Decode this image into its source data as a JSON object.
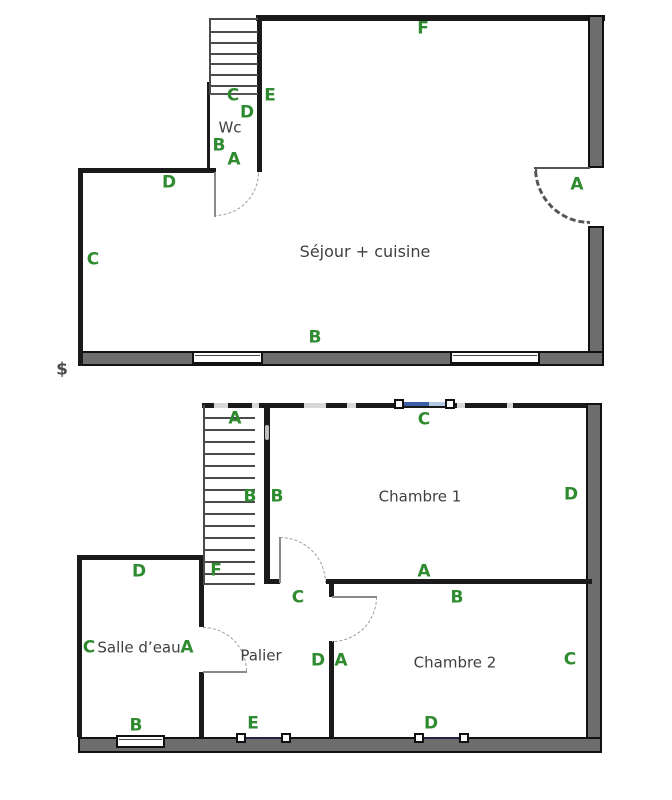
{
  "palette": {
    "wall": "#1a1a1a",
    "ext_fill": "#6d6d6d",
    "door_arc": "#9a9a9a",
    "door_arc_bold": "#565656",
    "marker_green": "#2f8b2f",
    "room_text": "#3f3f3f",
    "velux_dark": "#3d5fa8",
    "velux_light": "#b3c9e6",
    "velux_line": "#23233f"
  },
  "floor1": {
    "name": "ground-floor-plan",
    "walls": [
      [
        "top-wall",
        256,
        15,
        349,
        6,
        "solid"
      ],
      [
        "right-wall-upper",
        588,
        15,
        16,
        153,
        "ext"
      ],
      [
        "right-wall-lower",
        588,
        226,
        16,
        140,
        "ext"
      ],
      [
        "bottom-wall",
        78,
        351,
        526,
        15,
        "ext"
      ],
      [
        "left-wall",
        78,
        168,
        5,
        198,
        "solid"
      ],
      [
        "top-left-wall",
        78,
        168,
        138,
        5,
        "solid"
      ],
      [
        "wc-right-wall",
        257,
        15,
        5,
        157,
        "solid"
      ],
      [
        "wc-left-wall",
        207,
        82,
        3,
        90,
        "solid"
      ],
      [
        "wc-top-line",
        209,
        93,
        49,
        2,
        "thin"
      ]
    ],
    "windows": [
      [
        "window-1",
        192,
        351,
        71,
        13
      ],
      [
        "window-2",
        450,
        351,
        90,
        13
      ]
    ],
    "stairs": [
      {
        "n": "stairs-up",
        "x": 209,
        "y": 18,
        "w": 49,
        "h": 76,
        "treads": 6,
        "edges": [
          "top",
          "left"
        ]
      }
    ],
    "doors": [
      {
        "n": "wc-door",
        "x": 215,
        "y": 172,
        "r": 44,
        "corner": "br",
        "leaf": [
          214,
          172,
          2,
          45
        ]
      },
      {
        "n": "entry-door",
        "x": 534,
        "y": 168,
        "r": 56,
        "corner": "bl",
        "bold": true,
        "leaf": [
          534,
          167,
          56,
          2
        ]
      }
    ],
    "veluxes": [],
    "gaps": [],
    "marks": [],
    "markers": [
      [
        "F",
        423,
        29
      ],
      [
        "C",
        233,
        96
      ],
      [
        "E",
        270,
        96
      ],
      [
        "D",
        247,
        113
      ],
      [
        "B",
        219,
        146
      ],
      [
        "A",
        234,
        160
      ],
      [
        "D",
        169,
        183
      ],
      [
        "A",
        577,
        185
      ],
      [
        "C",
        93,
        260
      ],
      [
        "B",
        315,
        338
      ]
    ],
    "texts": [
      {
        "n": "room-label-wc",
        "t": "Wc",
        "x": 230,
        "y": 128,
        "s": 15
      },
      {
        "n": "room-label-sejour-cuisine",
        "t": "Séjour + cuisine",
        "x": 365,
        "y": 252,
        "s": 16
      },
      {
        "n": "dollar-sign",
        "t": "$",
        "x": 62,
        "y": 370,
        "s": 17,
        "bold": true
      }
    ]
  },
  "floor2": {
    "name": "upper-floor-plan",
    "walls": [
      [
        "top-wall",
        202,
        403,
        390,
        5,
        "solid"
      ],
      [
        "right-wall",
        586,
        403,
        16,
        350,
        "ext"
      ],
      [
        "bottom-wall",
        78,
        737,
        524,
        16,
        "ext"
      ],
      [
        "salle-top-wall",
        77,
        555,
        127,
        5,
        "solid"
      ],
      [
        "salle-left-wall",
        77,
        555,
        5,
        182,
        "solid"
      ],
      [
        "salle-right-wall-upper",
        199,
        555,
        5,
        72,
        "solid"
      ],
      [
        "salle-right-wall-lower",
        199,
        672,
        5,
        65,
        "solid"
      ],
      [
        "ch1-left-wall",
        264,
        403,
        6,
        180,
        "solid"
      ],
      [
        "ch1-bottom-wall-left",
        264,
        579,
        16,
        5,
        "solid"
      ],
      [
        "ch1-bottom-wall-right",
        326,
        579,
        266,
        5,
        "solid"
      ],
      [
        "mid-wall-upper",
        329,
        584,
        5,
        13,
        "solid"
      ],
      [
        "mid-wall-lower",
        329,
        641,
        5,
        96,
        "solid"
      ]
    ],
    "windows": [
      [
        "salle-window",
        116,
        735,
        49,
        13
      ]
    ],
    "stairs": [
      {
        "n": "stairs-down",
        "x": 203,
        "y": 405,
        "w": 52,
        "h": 180,
        "treads": 14,
        "edges": [
          "left",
          "bottom"
        ]
      }
    ],
    "doors": [
      {
        "n": "chambre1-door",
        "x": 280,
        "y": 537,
        "r": 46,
        "corner": "tr",
        "leaf": [
          279,
          537,
          2,
          46
        ]
      },
      {
        "n": "chambre2-door",
        "x": 332,
        "y": 597,
        "r": 45,
        "corner": "br",
        "leaf": [
          332,
          596,
          45,
          2
        ]
      },
      {
        "n": "salle-deau-door",
        "x": 203,
        "y": 627,
        "r": 44,
        "corner": "tr",
        "leaf": [
          203,
          671,
          44,
          2
        ]
      }
    ],
    "veluxes": [
      {
        "n": "roof-window-top",
        "squares": [
          [
            394,
            399
          ],
          [
            445,
            399
          ]
        ],
        "segs": [
          [
            403,
            402,
            26,
            "dark"
          ],
          [
            429,
            402,
            17,
            "light"
          ]
        ]
      },
      {
        "n": "roof-window-palier",
        "squares": [
          [
            236,
            733
          ],
          [
            281,
            733
          ]
        ],
        "segs": [
          [
            245,
            737,
            37,
            "line"
          ]
        ]
      },
      {
        "n": "roof-window-chambre2",
        "squares": [
          [
            414,
            733
          ],
          [
            459,
            733
          ]
        ],
        "segs": [
          [
            423,
            737,
            37,
            "line"
          ]
        ]
      }
    ],
    "gaps": [
      [
        214,
        403,
        14,
        5
      ],
      [
        252,
        403,
        7,
        5
      ],
      [
        304,
        403,
        22,
        5
      ],
      [
        347,
        403,
        9,
        5
      ],
      [
        457,
        403,
        8,
        5
      ],
      [
        507,
        403,
        6,
        5
      ]
    ],
    "marks": [
      [
        265,
        425,
        4,
        15
      ]
    ],
    "markers": [
      [
        "A",
        235,
        419
      ],
      [
        "C",
        424,
        420
      ],
      [
        "B",
        250,
        497
      ],
      [
        "B",
        277,
        497
      ],
      [
        "D",
        571,
        495
      ],
      [
        "A",
        424,
        572
      ],
      [
        "C",
        298,
        598
      ],
      [
        "B",
        457,
        598
      ],
      [
        "D",
        139,
        572
      ],
      [
        "F",
        216,
        571
      ],
      [
        "C",
        89,
        648
      ],
      [
        "A",
        187,
        648
      ],
      [
        "D",
        318,
        661
      ],
      [
        "A",
        341,
        661
      ],
      [
        "C",
        570,
        660
      ],
      [
        "B",
        136,
        726
      ],
      [
        "E",
        253,
        724
      ],
      [
        "D",
        431,
        724
      ]
    ],
    "texts": [
      {
        "n": "room-label-chambre-1",
        "t": "Chambre 1",
        "x": 420,
        "y": 497,
        "s": 15
      },
      {
        "n": "room-label-chambre-2",
        "t": "Chambre 2",
        "x": 455,
        "y": 663,
        "s": 15
      },
      {
        "n": "room-label-salle-deau",
        "t": "Salle d’eau",
        "x": 139,
        "y": 648,
        "s": 15
      },
      {
        "n": "room-label-palier",
        "t": "Palier",
        "x": 261,
        "y": 656,
        "s": 15
      }
    ]
  }
}
